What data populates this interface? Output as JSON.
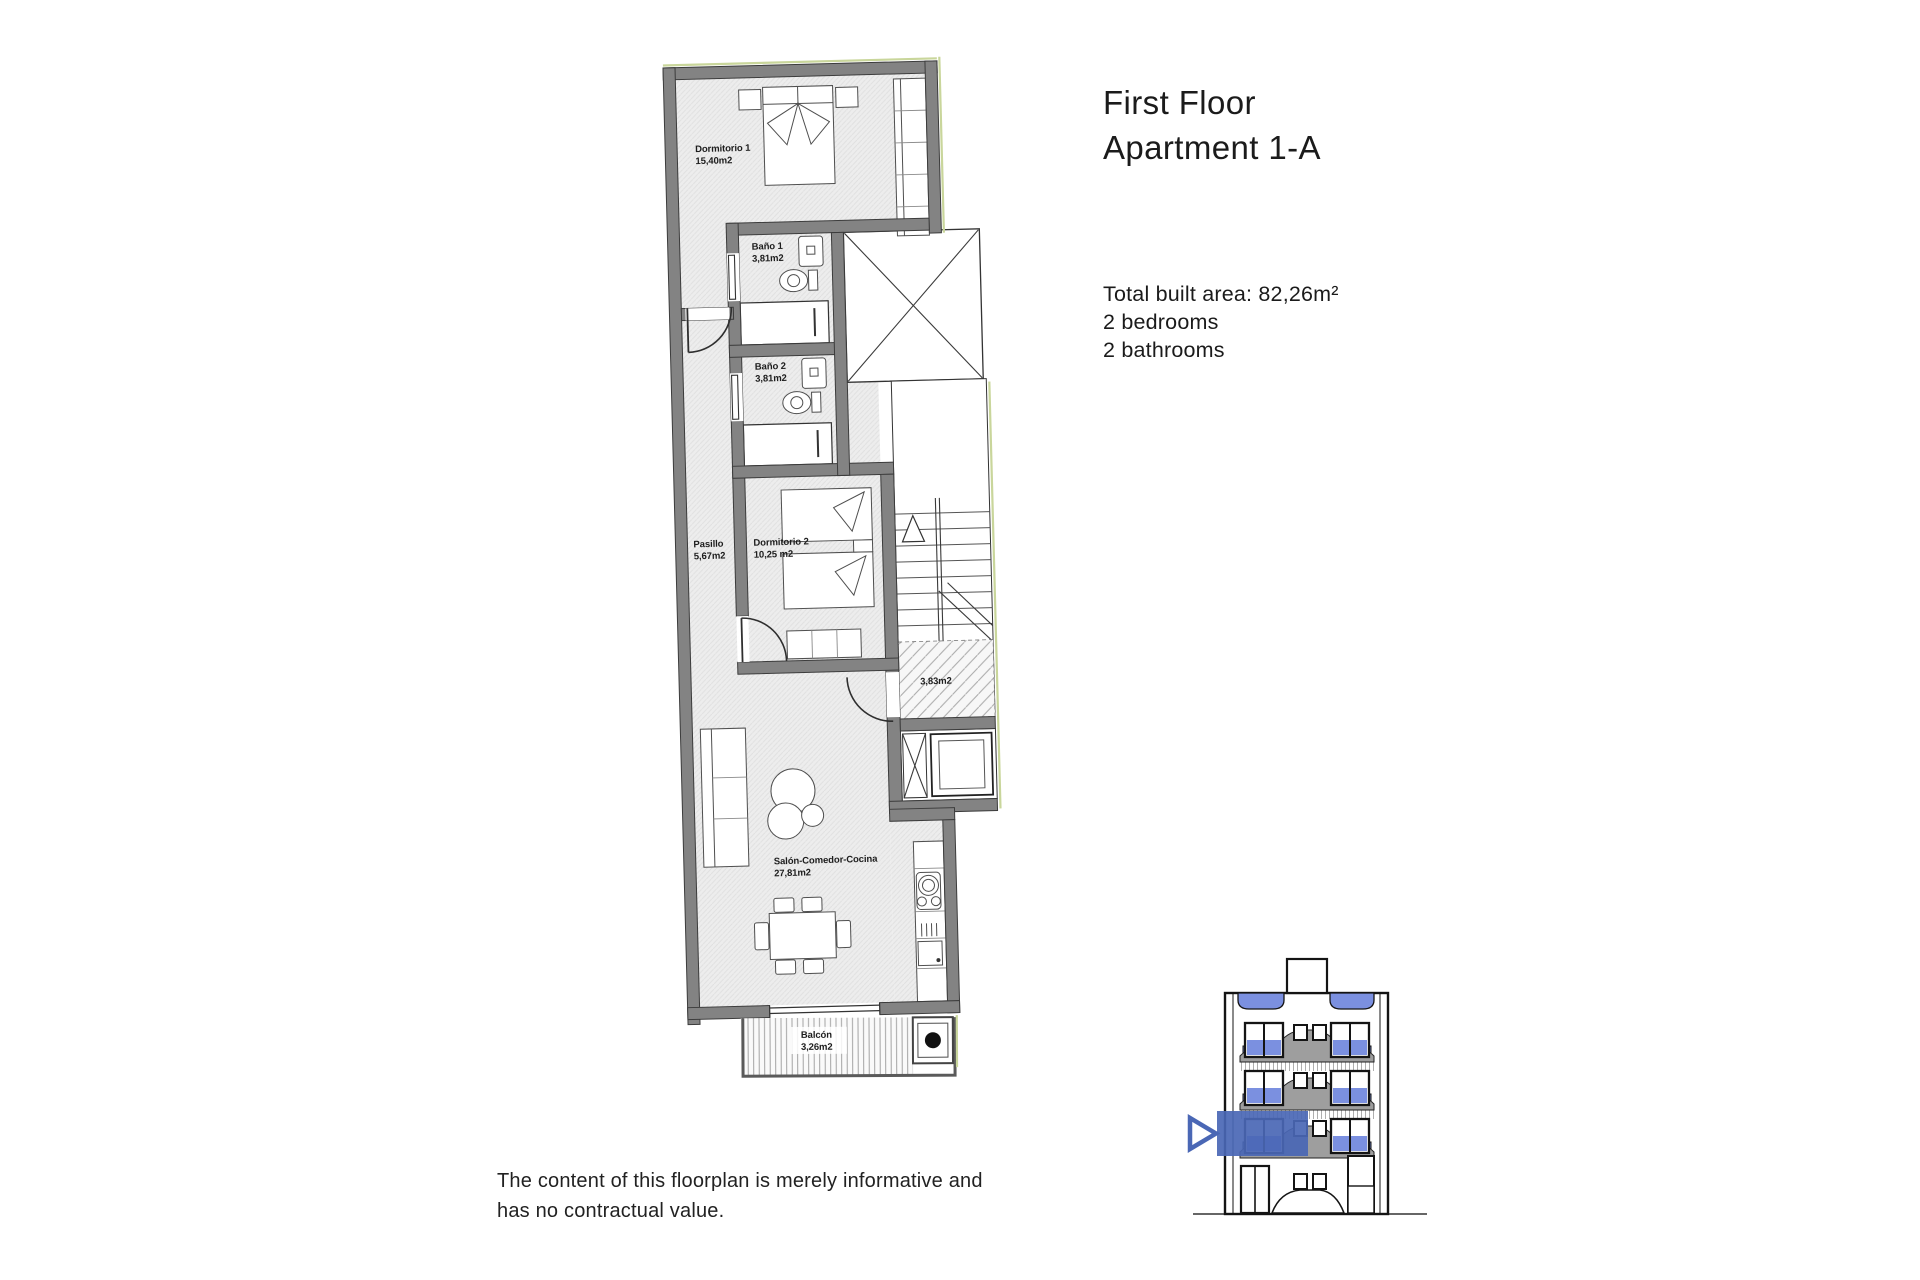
{
  "page": {
    "background": "#ffffff"
  },
  "header": {
    "title_line1": "First Floor",
    "title_line2": "Apartment 1-A"
  },
  "summary": {
    "built_area": "Total built area: 82,26m²",
    "bedrooms": "2 bedrooms",
    "bathrooms": "2 bathrooms"
  },
  "disclaimer": {
    "line1": "The content of this floorplan is merely informative and",
    "line2": "has no contractual value."
  },
  "floorplan": {
    "rooms": {
      "dormitorio1": {
        "name": "Dormitorio 1",
        "area": "15,40m2"
      },
      "bano1": {
        "name": "Baño 1",
        "area": "3,81m2"
      },
      "bano2": {
        "name": "Baño 2",
        "area": "3,81m2"
      },
      "pasillo": {
        "name": "Pasillo",
        "area": "5,67m2"
      },
      "dormitorio2": {
        "name": "Dormitorio 2",
        "area": "10,25 m2"
      },
      "landing": {
        "area": "3,83m2"
      },
      "salon": {
        "name": "Salón-Comedor-Cocina",
        "area": "27,81m2"
      },
      "balcon": {
        "name": "Balcón",
        "area": "3,26m2"
      }
    }
  },
  "colors": {
    "wall_gray": "#838383",
    "floor_tint": "#ededed",
    "accent_blue": "#4a67b5",
    "window_blue": "#7b90e0",
    "balcony_gray": "#9e9e9e",
    "boundary_green": "#c9d69b"
  }
}
